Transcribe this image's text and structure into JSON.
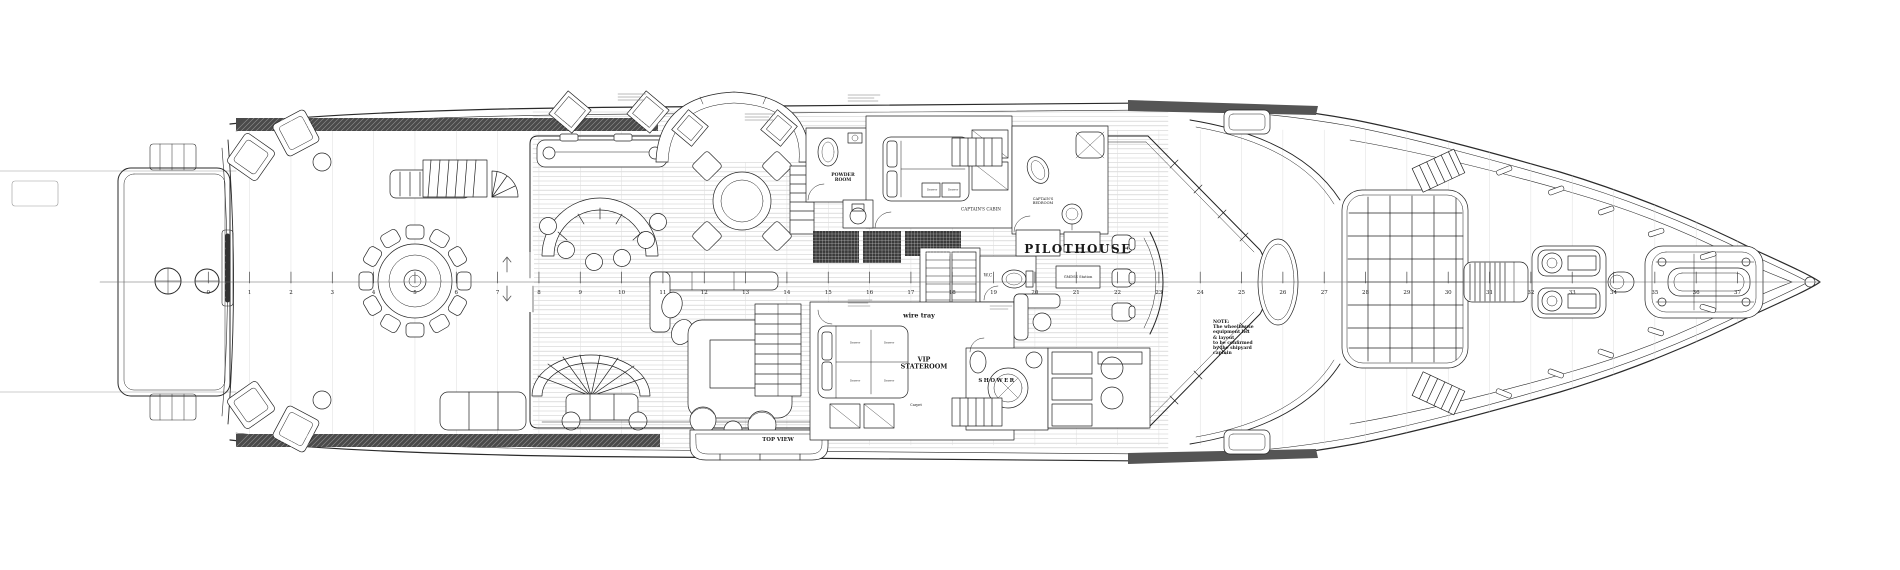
{
  "drawing": {
    "labels": {
      "powder_room": "POWDER\nROOM",
      "captains_cabin": "CAPTAIN'S CABIN",
      "captains_bedroom": "CAPTAIN'S\nBEDROOM",
      "pilothouse": "PILOTHOUSE",
      "gmdss": "GMDSS Station",
      "wc": "W.C",
      "wire_tray": "wire tray",
      "vip_stateroom": "VIP\nSTATEROOM",
      "shower": "SHOWER",
      "top_view": "TOP VIEW",
      "carpet": "Carpet",
      "drawer": "Drawer",
      "note": "NOTE:\nThe wheelhouse\nequipment list\n& layout\nto be confirmed\nby the shipyard\ncaptain"
    },
    "frame_numbers": [
      "0",
      "1",
      "2",
      "3",
      "4",
      "5",
      "6",
      "7",
      "8",
      "9",
      "10",
      "11",
      "12",
      "13",
      "14",
      "15",
      "16",
      "17",
      "18",
      "19",
      "20",
      "21",
      "22",
      "23",
      "24",
      "25",
      "26",
      "27",
      "28",
      "29",
      "30",
      "31",
      "32",
      "33",
      "34",
      "35",
      "36",
      "37"
    ]
  }
}
